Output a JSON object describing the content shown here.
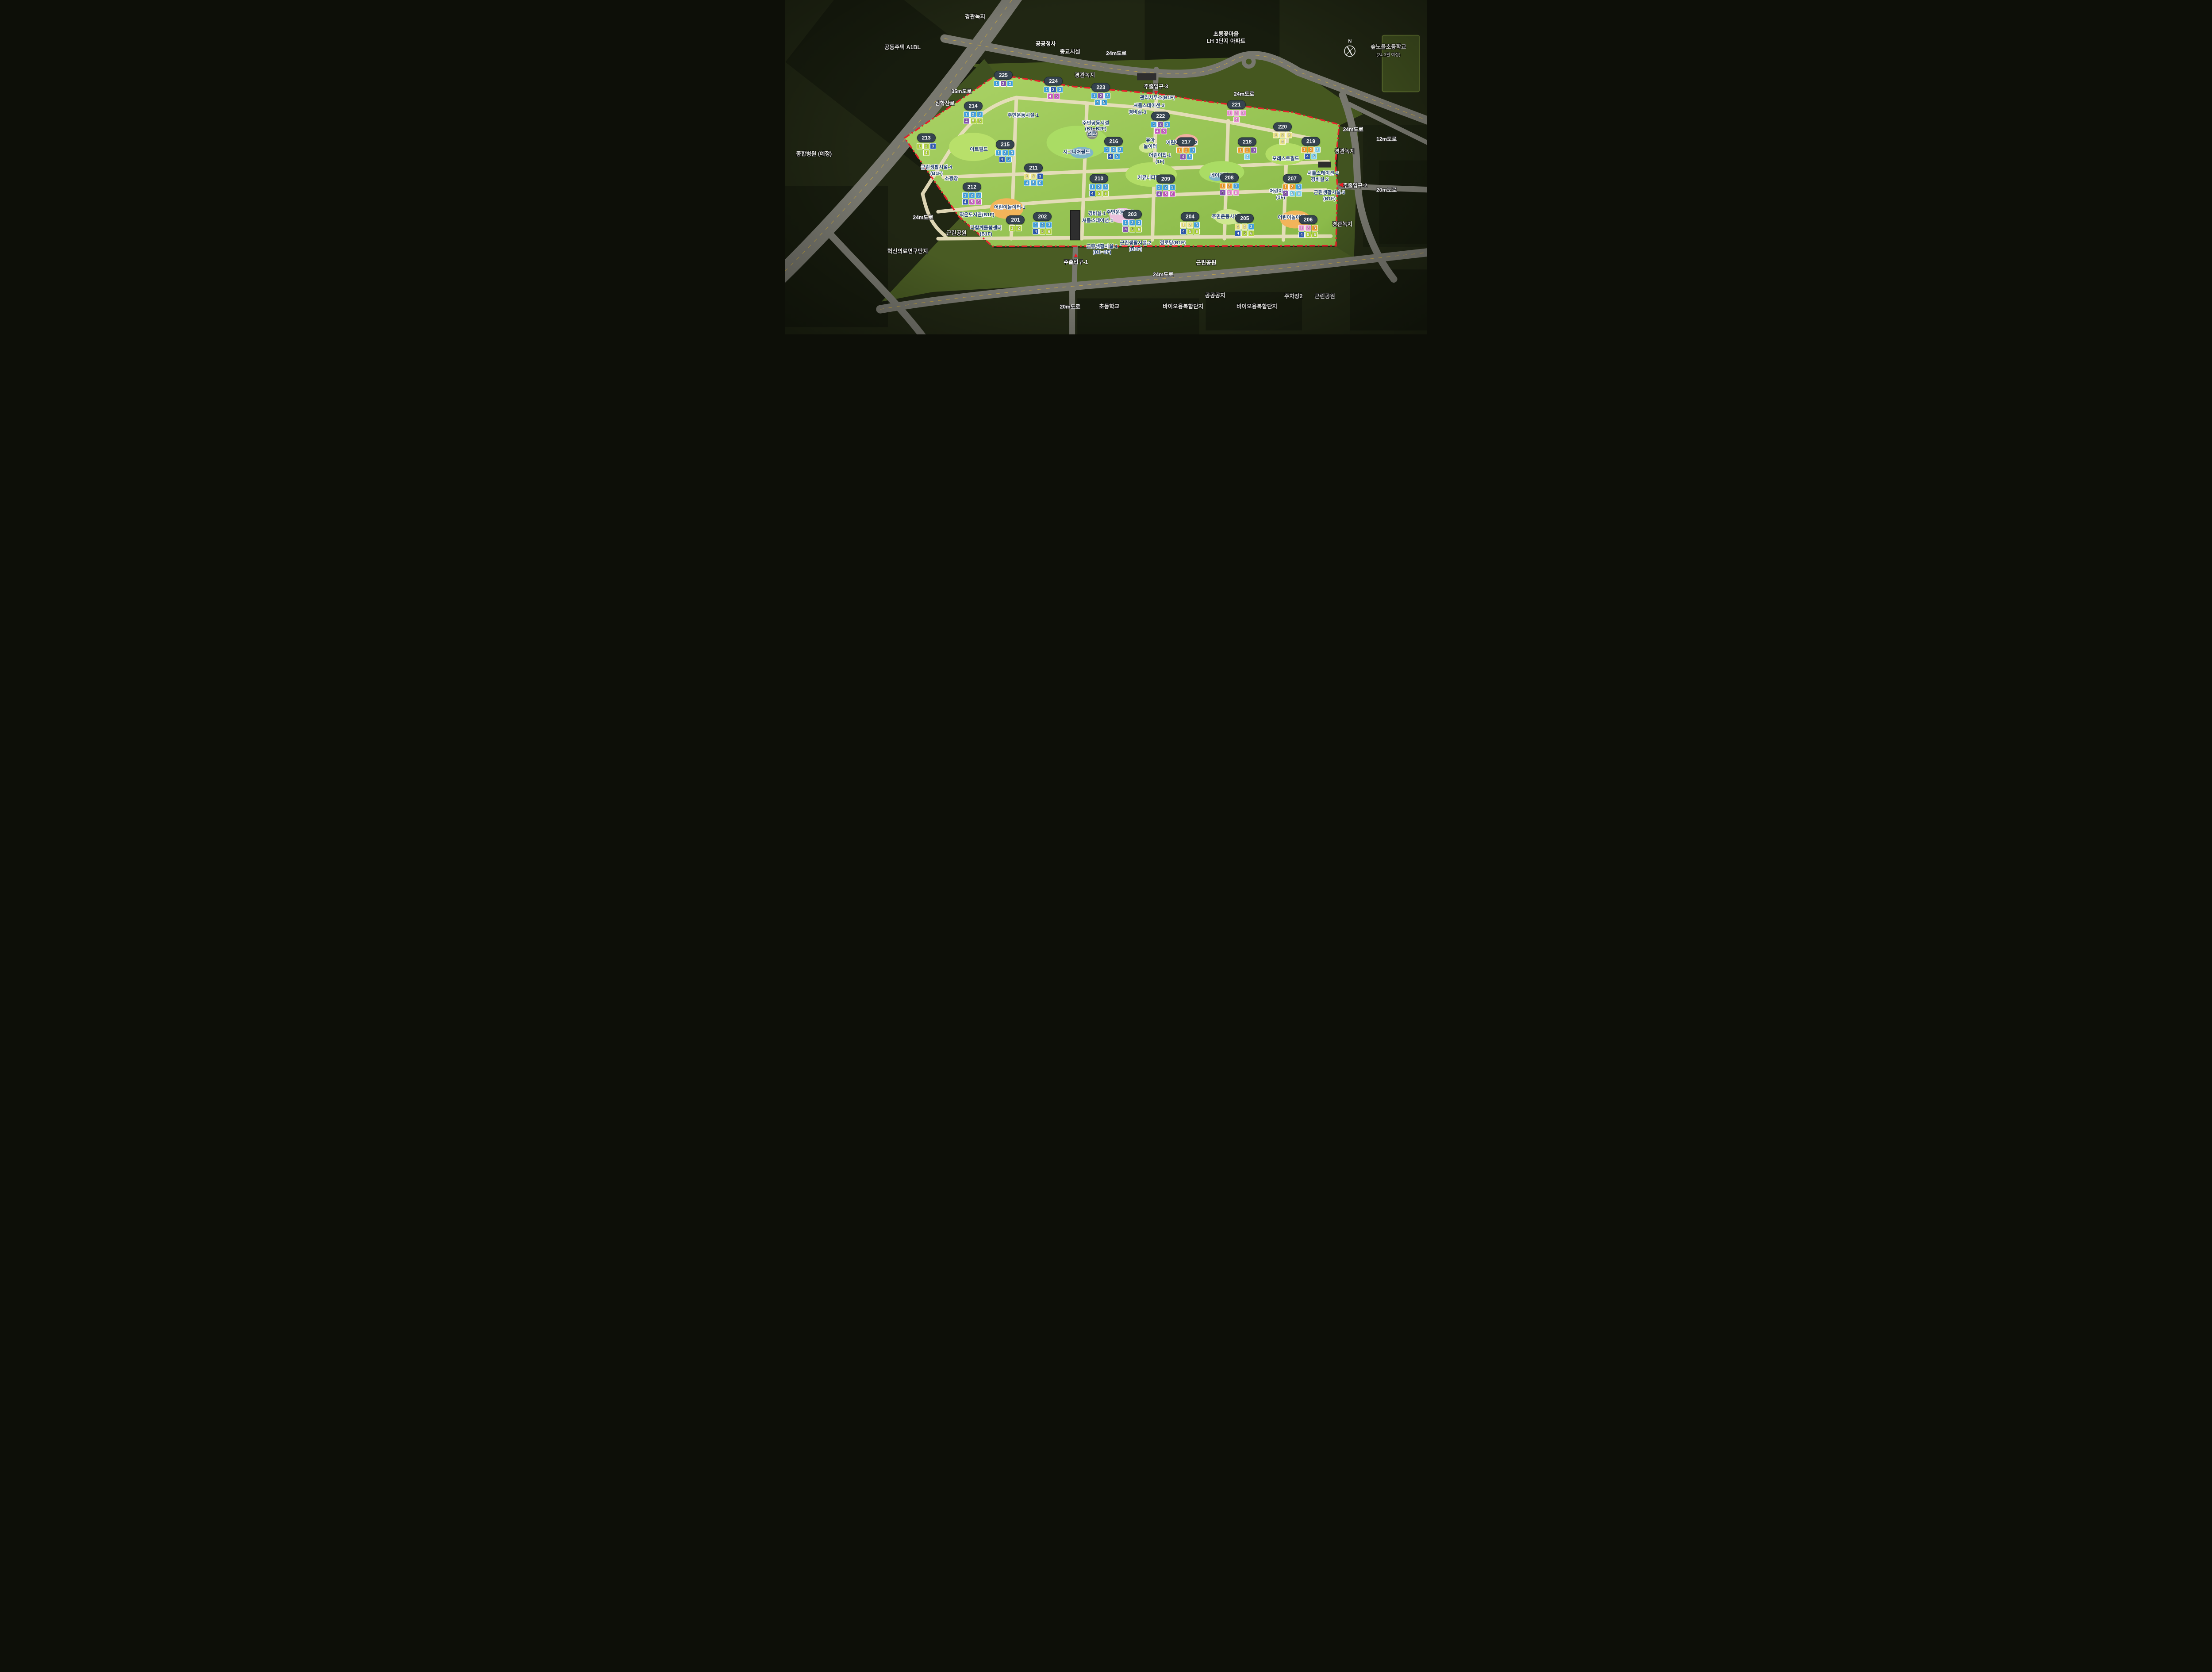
{
  "colors": {
    "boundary": "#e6202a",
    "badge": "#36444f",
    "site_green": "#98c352",
    "entrance_arrow": "#ec1c24"
  },
  "unit_palette": {
    "blue": "#45a7e6",
    "lightblue": "#86d7f5",
    "navy": "#2f5cb8",
    "purple": "#8a57b5",
    "magenta": "#cf5fc8",
    "pink": "#ef93d5",
    "green": "#b5d842",
    "yellow": "#f0e88a",
    "orange": "#f5a12c"
  },
  "buildings": [
    {
      "id": "201",
      "x": 35.9,
      "y": 66.8,
      "units": [
        [
          "1",
          "green"
        ],
        [
          "2",
          "green"
        ]
      ]
    },
    {
      "id": "202",
      "x": 40.1,
      "y": 66.8,
      "units": [
        [
          "1",
          "blue"
        ],
        [
          "2",
          "blue"
        ],
        [
          "3",
          "blue"
        ],
        [
          "4",
          "navy"
        ],
        [
          "5",
          "green"
        ],
        [
          "6",
          "green"
        ]
      ]
    },
    {
      "id": "203",
      "x": 54.1,
      "y": 66.1,
      "units": [
        [
          "1",
          "blue"
        ],
        [
          "2",
          "blue"
        ],
        [
          "3",
          "blue"
        ],
        [
          "4",
          "purple"
        ],
        [
          "5",
          "green"
        ],
        [
          "6",
          "green"
        ]
      ]
    },
    {
      "id": "204",
      "x": 63.1,
      "y": 66.8,
      "units": [
        [
          "1",
          "yellow"
        ],
        [
          "2",
          "yellow"
        ],
        [
          "3",
          "blue"
        ],
        [
          "4",
          "navy"
        ],
        [
          "5",
          "green"
        ],
        [
          "6",
          "green"
        ]
      ]
    },
    {
      "id": "205",
      "x": 71.6,
      "y": 67.3,
      "units": [
        [
          "1",
          "yellow"
        ],
        [
          "2",
          "yellow"
        ],
        [
          "3",
          "blue"
        ],
        [
          "4",
          "navy"
        ],
        [
          "5",
          "green"
        ],
        [
          "6",
          "green"
        ]
      ]
    },
    {
      "id": "206",
      "x": 81.5,
      "y": 67.8,
      "units": [
        [
          "1",
          "pink"
        ],
        [
          "2",
          "pink"
        ],
        [
          "3",
          "orange"
        ],
        [
          "4",
          "navy"
        ],
        [
          "5",
          "green"
        ],
        [
          "6",
          "green"
        ]
      ]
    },
    {
      "id": "207",
      "x": 79.0,
      "y": 55.4,
      "units": [
        [
          "1",
          "orange"
        ],
        [
          "2",
          "orange"
        ],
        [
          "3",
          "blue"
        ],
        [
          "4",
          "purple"
        ],
        [
          "5",
          "lightblue"
        ],
        [
          "6",
          "lightblue"
        ]
      ]
    },
    {
      "id": "208",
      "x": 69.2,
      "y": 55.2,
      "units": [
        [
          "1",
          "orange"
        ],
        [
          "2",
          "orange"
        ],
        [
          "3",
          "blue"
        ],
        [
          "4",
          "purple"
        ],
        [
          "5",
          "pink"
        ],
        [
          "6",
          "pink"
        ]
      ]
    },
    {
      "id": "209",
      "x": 59.3,
      "y": 55.6,
      "units": [
        [
          "1",
          "blue"
        ],
        [
          "2",
          "blue"
        ],
        [
          "3",
          "blue"
        ],
        [
          "4",
          "purple"
        ],
        [
          "5",
          "magenta"
        ],
        [
          "6",
          "magenta"
        ]
      ]
    },
    {
      "id": "210",
      "x": 48.9,
      "y": 55.4,
      "units": [
        [
          "1",
          "blue"
        ],
        [
          "2",
          "blue"
        ],
        [
          "3",
          "blue"
        ],
        [
          "4",
          "navy"
        ],
        [
          "5",
          "green"
        ],
        [
          "6",
          "green"
        ]
      ]
    },
    {
      "id": "211",
      "x": 38.7,
      "y": 52.3,
      "units": [
        [
          "1",
          "yellow"
        ],
        [
          "2",
          "yellow"
        ],
        [
          "3",
          "navy"
        ],
        [
          "4",
          "blue"
        ],
        [
          "5",
          "blue"
        ],
        [
          "6",
          "blue"
        ]
      ]
    },
    {
      "id": "212",
      "x": 29.1,
      "y": 58.0,
      "units": [
        [
          "1",
          "blue"
        ],
        [
          "2",
          "blue"
        ],
        [
          "3",
          "blue"
        ],
        [
          "4",
          "navy"
        ],
        [
          "5",
          "magenta"
        ],
        [
          "6",
          "magenta"
        ]
      ]
    },
    {
      "id": "213",
      "x": 22.0,
      "y": 43.3,
      "units": [
        [
          "1",
          "green"
        ],
        [
          "2",
          "green"
        ],
        [
          "3",
          "navy"
        ],
        [
          "4",
          "green"
        ]
      ]
    },
    {
      "id": "214",
      "x": 29.3,
      "y": 33.8,
      "units": [
        [
          "1",
          "blue"
        ],
        [
          "2",
          "blue"
        ],
        [
          "3",
          "blue"
        ],
        [
          "4",
          "purple"
        ],
        [
          "5",
          "green"
        ],
        [
          "6",
          "green"
        ]
      ]
    },
    {
      "id": "215",
      "x": 34.3,
      "y": 45.2,
      "units": [
        [
          "1",
          "blue"
        ],
        [
          "2",
          "blue"
        ],
        [
          "3",
          "blue"
        ],
        [
          "4",
          "navy"
        ],
        [
          "5",
          "blue"
        ]
      ]
    },
    {
      "id": "216",
      "x": 51.2,
      "y": 44.3,
      "units": [
        [
          "1",
          "blue"
        ],
        [
          "2",
          "blue"
        ],
        [
          "3",
          "blue"
        ],
        [
          "4",
          "navy"
        ],
        [
          "5",
          "blue"
        ]
      ]
    },
    {
      "id": "217",
      "x": 62.5,
      "y": 44.5,
      "units": [
        [
          "1",
          "orange"
        ],
        [
          "2",
          "orange"
        ],
        [
          "3",
          "blue"
        ],
        [
          "4",
          "purple"
        ],
        [
          "5",
          "blue"
        ]
      ]
    },
    {
      "id": "218",
      "x": 72.0,
      "y": 44.5,
      "units": [
        [
          "1",
          "orange"
        ],
        [
          "2",
          "orange"
        ],
        [
          "3",
          "purple"
        ],
        [
          "4",
          "lightblue"
        ]
      ]
    },
    {
      "id": "219",
      "x": 81.9,
      "y": 44.3,
      "units": [
        [
          "1",
          "orange"
        ],
        [
          "2",
          "orange"
        ],
        [
          "3",
          "lightblue"
        ],
        [
          "4",
          "navy"
        ],
        [
          "5",
          "lightblue"
        ]
      ]
    },
    {
      "id": "220",
      "x": 77.5,
      "y": 40.0,
      "units": [
        [
          "1",
          "yellow"
        ],
        [
          "2",
          "yellow"
        ],
        [
          "3",
          "yellow"
        ],
        [
          "4",
          "yellow"
        ]
      ]
    },
    {
      "id": "221",
      "x": 70.3,
      "y": 33.4,
      "units": [
        [
          "1",
          "pink"
        ],
        [
          "2",
          "pink"
        ],
        [
          "3",
          "pink"
        ],
        [
          "4",
          "pink"
        ]
      ]
    },
    {
      "id": "222",
      "x": 58.5,
      "y": 36.8,
      "units": [
        [
          "1",
          "blue"
        ],
        [
          "2",
          "purple"
        ],
        [
          "3",
          "blue"
        ],
        [
          "4",
          "magenta"
        ],
        [
          "5",
          "magenta"
        ]
      ]
    },
    {
      "id": "223",
      "x": 49.2,
      "y": 28.2,
      "units": [
        [
          "1",
          "blue"
        ],
        [
          "2",
          "purple"
        ],
        [
          "3",
          "blue"
        ],
        [
          "4",
          "blue"
        ],
        [
          "5",
          "blue"
        ]
      ]
    },
    {
      "id": "224",
      "x": 41.8,
      "y": 26.3,
      "units": [
        [
          "1",
          "blue"
        ],
        [
          "2",
          "navy"
        ],
        [
          "3",
          "blue"
        ],
        [
          "4",
          "magenta"
        ],
        [
          "5",
          "magenta"
        ]
      ]
    },
    {
      "id": "225",
      "x": 34.0,
      "y": 23.5,
      "units": [
        [
          "1",
          "blue"
        ],
        [
          "2",
          "purple"
        ],
        [
          "3",
          "blue"
        ]
      ]
    }
  ],
  "facilities": [
    {
      "t": "주민운동시설-1",
      "x": 37.1,
      "y": 34.6
    },
    {
      "t": "주민공동시설\n(B1~B2F)",
      "x": 48.4,
      "y": 37.8
    },
    {
      "t": "관리사무소(B1F)",
      "x": 58.0,
      "y": 29.4
    },
    {
      "t": "셔틀스테이션-3",
      "x": 56.7,
      "y": 31.8
    },
    {
      "t": "경비실-3",
      "x": 54.9,
      "y": 33.8
    },
    {
      "t": "선큰",
      "x": 47.8,
      "y": 40.2
    },
    {
      "t": "시그니처필드",
      "x": 45.4,
      "y": 45.7
    },
    {
      "t": "아트필드",
      "x": 30.2,
      "y": 44.8
    },
    {
      "t": "유아\n놀이터",
      "x": 56.9,
      "y": 43.0
    },
    {
      "t": "어린이놀이터-2",
      "x": 61.8,
      "y": 42.9
    },
    {
      "t": "어린이집-1\n(1F)",
      "x": 58.4,
      "y": 47.5
    },
    {
      "t": "포레스트필드",
      "x": 78.0,
      "y": 47.6
    },
    {
      "t": "네이처필드",
      "x": 68.0,
      "y": 52.6
    },
    {
      "t": "커뮤니티필드",
      "x": 57.0,
      "y": 53.3
    },
    {
      "t": "근린생활시설-4\n(B1F)",
      "x": 23.6,
      "y": 51.1
    },
    {
      "t": "소광장",
      "x": 25.9,
      "y": 53.6
    },
    {
      "t": "어린이놀이터-1",
      "x": 35.0,
      "y": 62.2
    },
    {
      "t": "작은도서관(B1F)",
      "x": 29.9,
      "y": 64.5
    },
    {
      "t": "다함께돌봄센터\n(B1F)",
      "x": 31.3,
      "y": 69.2
    },
    {
      "t": "경비실-1",
      "x": 48.6,
      "y": 64.0
    },
    {
      "t": "셔틀스테이션-1",
      "x": 48.7,
      "y": 66.2
    },
    {
      "t": "주민운동시설-2",
      "x": 52.5,
      "y": 63.6
    },
    {
      "t": "주민운동시설-3",
      "x": 68.9,
      "y": 64.9
    },
    {
      "t": "어린이놀이터-3",
      "x": 79.2,
      "y": 65.2
    },
    {
      "t": "어린이집-2\n(1F)",
      "x": 77.2,
      "y": 58.2
    },
    {
      "t": "근린생활시설-3\n(B1F)",
      "x": 84.8,
      "y": 58.6
    },
    {
      "t": "셔틀스테이션-2",
      "x": 83.8,
      "y": 52.0
    },
    {
      "t": "경비실-2",
      "x": 83.3,
      "y": 53.8
    },
    {
      "t": "근린생활시설-1\n(B1~2F)",
      "x": 49.4,
      "y": 74.7
    },
    {
      "t": "근린생활시설-2\n(B1F)",
      "x": 54.6,
      "y": 73.7
    },
    {
      "t": "경로당(B1F)",
      "x": 60.4,
      "y": 72.8
    }
  ],
  "outside_labels": [
    {
      "t": "경관녹지",
      "x": 29.6,
      "y": 5.0
    },
    {
      "t": "공동주택 A1BL",
      "x": 18.3,
      "y": 14.2
    },
    {
      "t": "공공청사",
      "x": 40.6,
      "y": 13.1
    },
    {
      "t": "종교시설",
      "x": 44.4,
      "y": 15.5
    },
    {
      "t": "경관녹지",
      "x": 46.7,
      "y": 22.5
    },
    {
      "t": "초롱꽃마을\nLH 3단지 아파트",
      "x": 68.7,
      "y": 11.2
    },
    {
      "t": "숲노을초등학교",
      "x": 94.0,
      "y": 14.0
    },
    {
      "t": "(24.3월 예정)",
      "x": 94.0,
      "y": 16.6,
      "small": true
    },
    {
      "t": "경관녹지",
      "x": 87.2,
      "y": 45.2
    },
    {
      "t": "경관녹지",
      "x": 86.8,
      "y": 67.1
    },
    {
      "t": "종합병원 (예정)",
      "x": 4.5,
      "y": 46.0
    },
    {
      "t": "혁신의료연구단지",
      "x": 19.1,
      "y": 75.2
    },
    {
      "t": "근린공원",
      "x": 26.7,
      "y": 69.7
    },
    {
      "t": "근린공원",
      "x": 65.6,
      "y": 78.6
    },
    {
      "t": "초등학교",
      "x": 50.5,
      "y": 91.7
    },
    {
      "t": "바이오융복합단지",
      "x": 62.0,
      "y": 91.7
    },
    {
      "t": "공공공지",
      "x": 67.0,
      "y": 88.4
    },
    {
      "t": "바이오융복합단지",
      "x": 73.5,
      "y": 91.7
    },
    {
      "t": "주차장2",
      "x": 79.2,
      "y": 88.6
    },
    {
      "t": "근린공원",
      "x": 84.1,
      "y": 88.6
    }
  ],
  "road_labels": [
    {
      "t": "35m도로",
      "x": 27.5,
      "y": 27.2
    },
    {
      "t": "심학산로",
      "x": 24.9,
      "y": 30.8
    },
    {
      "t": "24m도로",
      "x": 51.6,
      "y": 15.9
    },
    {
      "t": "24m도로",
      "x": 71.5,
      "y": 28.0
    },
    {
      "t": "24m도로",
      "x": 88.5,
      "y": 38.6
    },
    {
      "t": "12m도로",
      "x": 93.7,
      "y": 41.5
    },
    {
      "t": "20m도로",
      "x": 93.7,
      "y": 56.7
    },
    {
      "t": "24m도로",
      "x": 21.5,
      "y": 64.9
    },
    {
      "t": "24m도로",
      "x": 58.9,
      "y": 82.0
    },
    {
      "t": "20m도로",
      "x": 44.4,
      "y": 91.7
    }
  ],
  "entrances": [
    {
      "t": "주출입구-1",
      "x": 45.3,
      "y": 78.3,
      "arrow": "▲",
      "ax": 45.3,
      "ay": 76.2
    },
    {
      "t": "주출입구-2",
      "x": 88.8,
      "y": 55.4,
      "arrow": "◀",
      "ax": 86.6,
      "ay": 55.2
    },
    {
      "t": "주출입구-3",
      "x": 57.8,
      "y": 25.8,
      "arrow": "▼",
      "ax": 57.8,
      "ay": 27.7
    }
  ],
  "compass": {
    "x": 88.0,
    "y": 14.4,
    "label": "N"
  }
}
